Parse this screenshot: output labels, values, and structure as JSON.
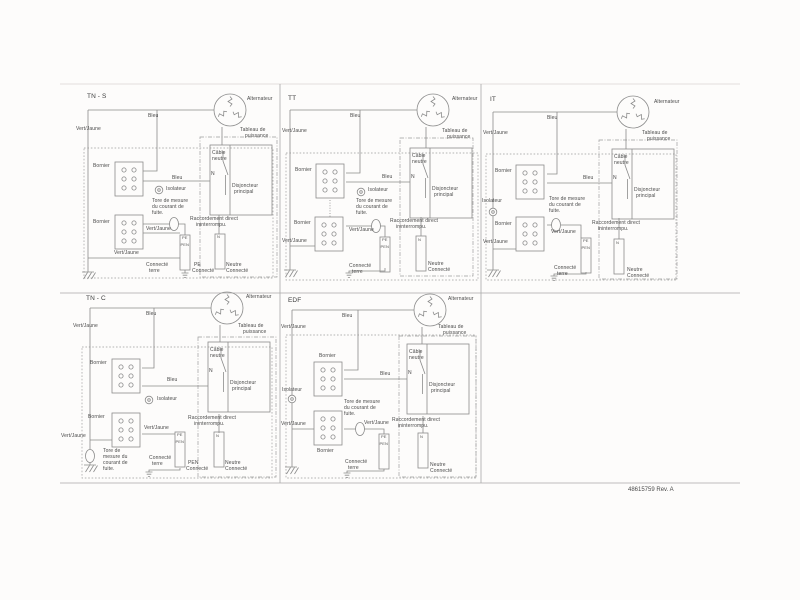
{
  "document": {
    "part_number": "48615759 Rev. A",
    "description_of_sheet": "Five French earthing-system wiring diagrams"
  },
  "panels": [
    {
      "title": "TN - S"
    },
    {
      "title": "TT"
    },
    {
      "title": "IT"
    },
    {
      "title": "TN - C"
    },
    {
      "title": "EDF"
    }
  ],
  "strings": {
    "alternateur": "Alternateur",
    "bleu": "Bleu",
    "vert_jaune": "Vert/Jaune",
    "tableau1": "Tableau de",
    "tableau2": "puissance",
    "bornier": "Bornier",
    "isolateur": "Isolateur",
    "cable1": "Câble",
    "cable2": "neutre",
    "n": "N",
    "disj1": "Disjoncteur",
    "disj2": "principal",
    "tore1": "Tore de mesure",
    "tore2": "du courant de",
    "tore3": "fuite.",
    "tnc_tore1": "Tore de",
    "tnc_tore2": "mesure du",
    "tnc_tore3": "courant de",
    "racc1": "Raccordement direct",
    "racc2": "ininterrompu.",
    "connecte": "Connecté",
    "terre": "terre",
    "pe": "PE",
    "pen": "PEN",
    "neutre": "Neutre"
  },
  "colors": {
    "wire": "#8b8b8b",
    "text": "#4a4a4a",
    "paper": "#fdfcfb"
  }
}
